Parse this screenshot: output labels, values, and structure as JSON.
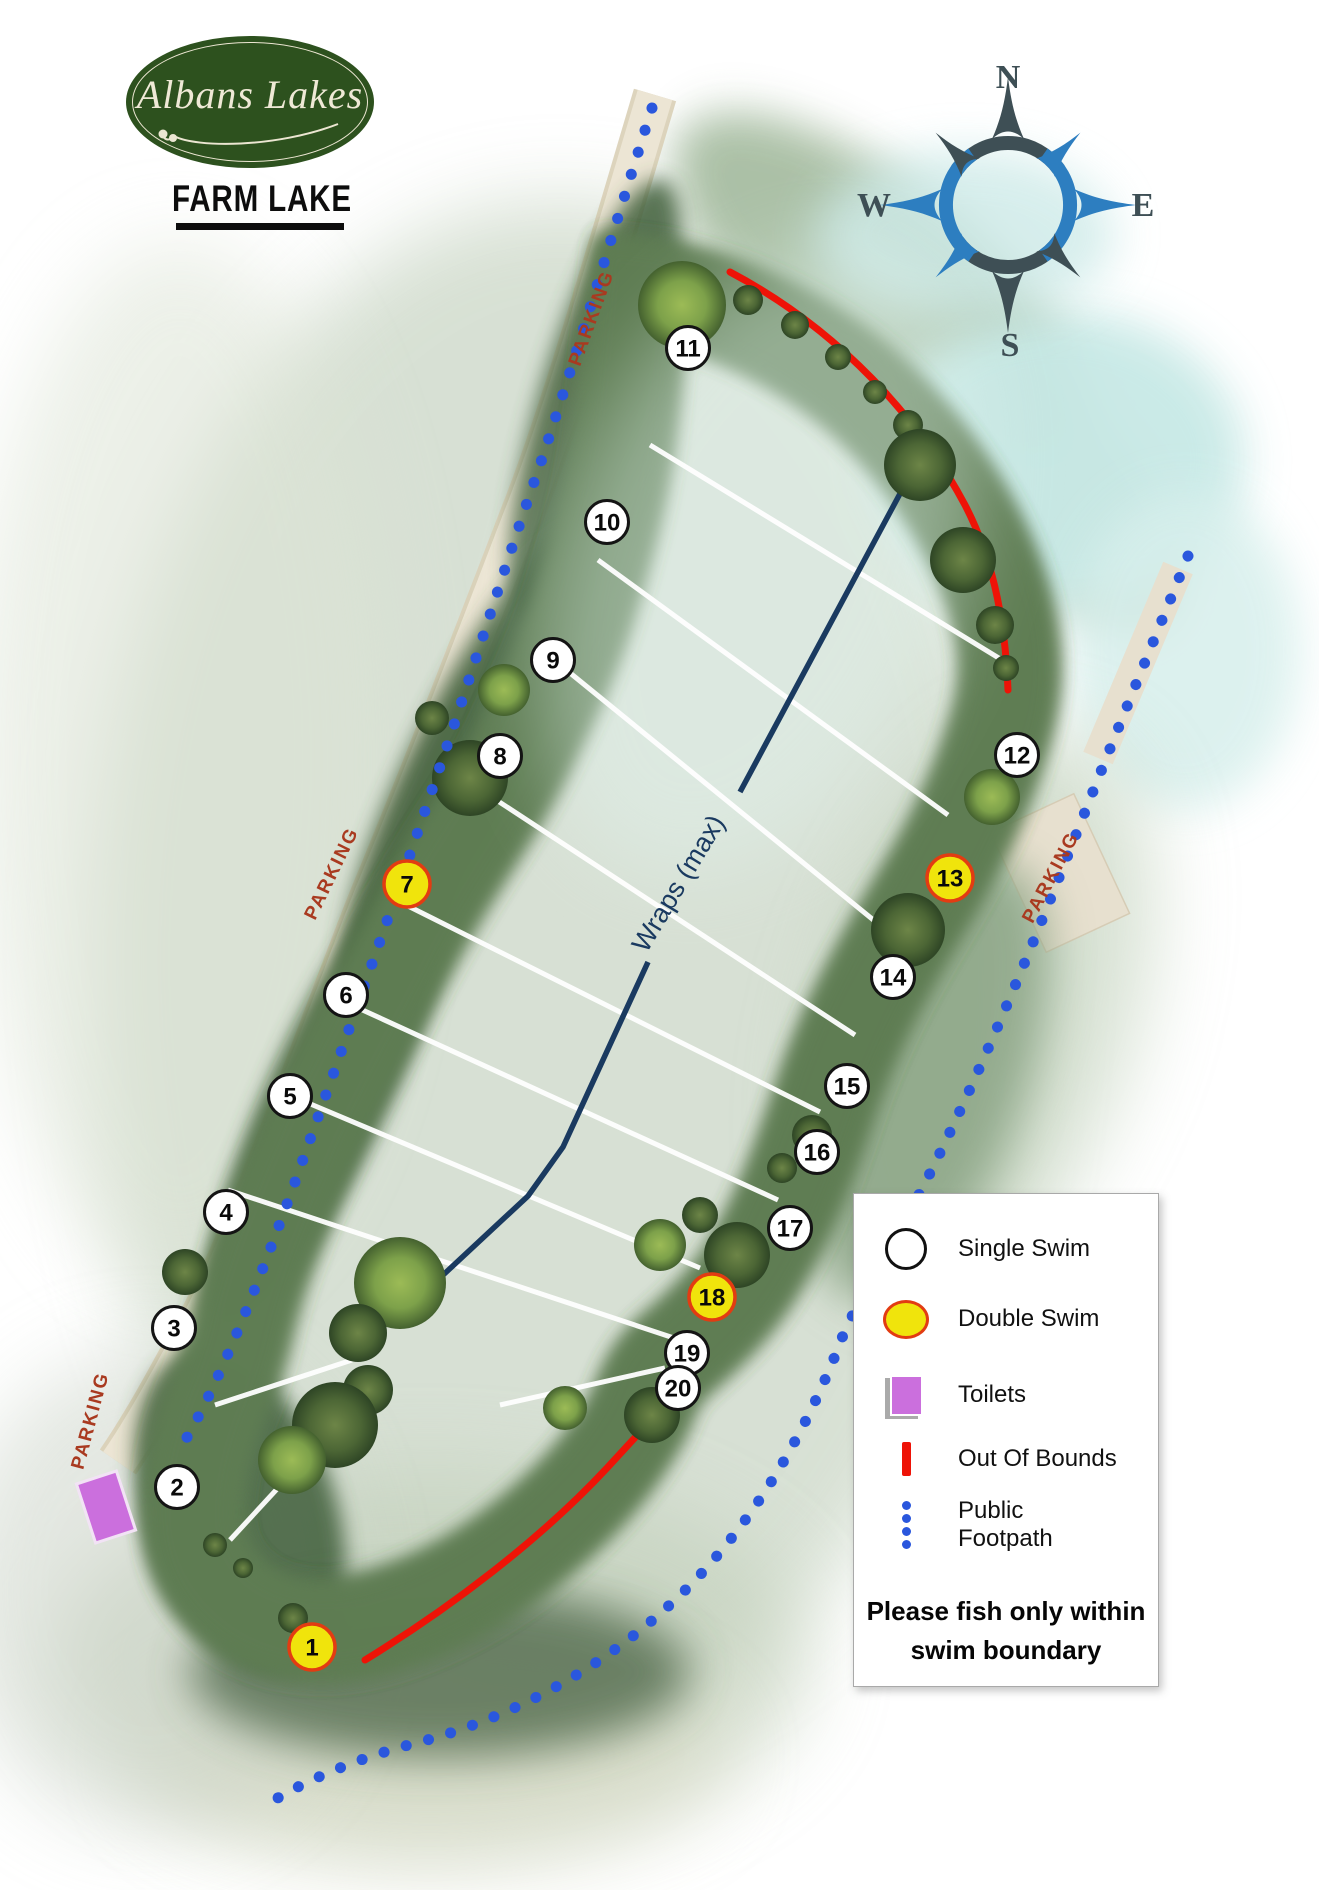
{
  "logo": {
    "brand": "Albans Lakes",
    "lake_name": "FARM LAKE"
  },
  "compass": {
    "north": "N",
    "east": "E",
    "south": "S",
    "west": "W"
  },
  "map": {
    "parking_label": "PARKING",
    "wraps_label": "Wraps (max)",
    "swims": [
      {
        "number": "1",
        "type": "double"
      },
      {
        "number": "2",
        "type": "single"
      },
      {
        "number": "3",
        "type": "single"
      },
      {
        "number": "4",
        "type": "single"
      },
      {
        "number": "5",
        "type": "single"
      },
      {
        "number": "6",
        "type": "single"
      },
      {
        "number": "7",
        "type": "double"
      },
      {
        "number": "8",
        "type": "single"
      },
      {
        "number": "9",
        "type": "single"
      },
      {
        "number": "10",
        "type": "single"
      },
      {
        "number": "11",
        "type": "single"
      },
      {
        "number": "12",
        "type": "single"
      },
      {
        "number": "13",
        "type": "double"
      },
      {
        "number": "14",
        "type": "single"
      },
      {
        "number": "15",
        "type": "single"
      },
      {
        "number": "16",
        "type": "single"
      },
      {
        "number": "17",
        "type": "single"
      },
      {
        "number": "18",
        "type": "double"
      },
      {
        "number": "19",
        "type": "single"
      },
      {
        "number": "20",
        "type": "single"
      }
    ]
  },
  "legend": {
    "single_swim": "Single Swim",
    "double_swim": "Double Swim",
    "toilets": "Toilets",
    "out_of_bounds": "Out Of Bounds",
    "footpath_line1": "Public",
    "footpath_line2": "Footpath",
    "note_line1": "Please fish only within",
    "note_line2": "swim boundary"
  },
  "colors": {
    "double_swim_fill": "#f0e40c",
    "double_swim_border": "#e23c12",
    "single_swim_border": "#141414",
    "out_of_bounds_red": "#ee1307",
    "footpath_blue": "#2a57dd",
    "toilets_purple": "#cb6fdd",
    "parking_text": "#a93a20",
    "wraps_navy": "#1a3a60",
    "compass_dark": "#3e4f55",
    "compass_blue": "#2d7ec0"
  }
}
